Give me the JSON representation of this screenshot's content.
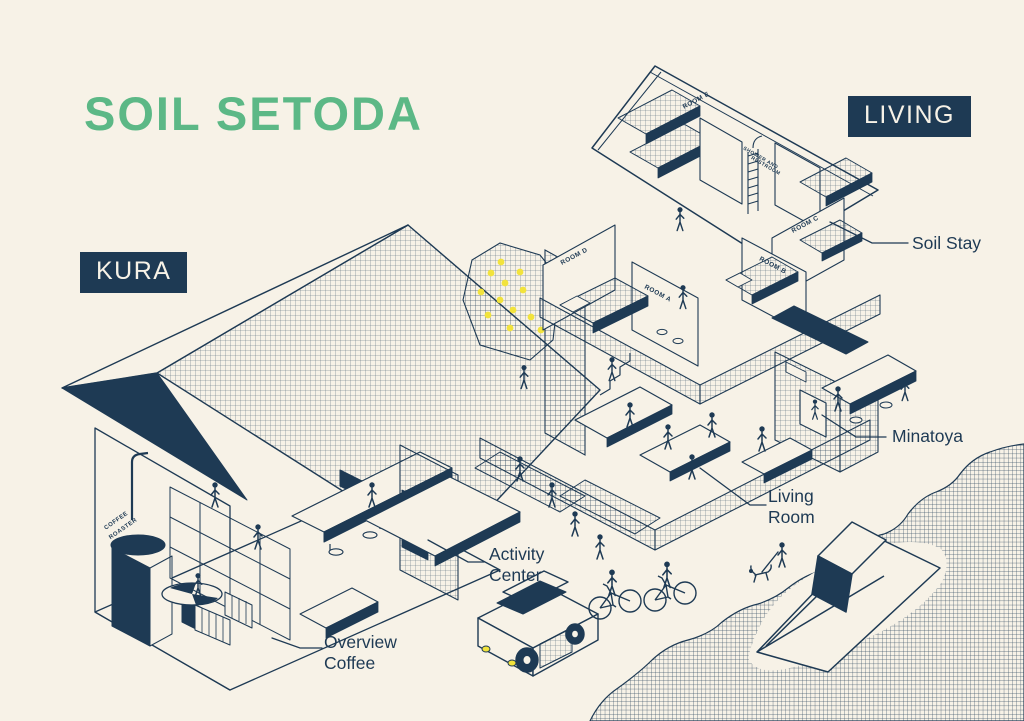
{
  "title": "SOIL SETODA",
  "badges": {
    "kura": "KURA",
    "living": "LIVING"
  },
  "callouts": [
    {
      "id": "soil-stay",
      "label": "Soil Stay"
    },
    {
      "id": "minatoya",
      "label": "Minatoya"
    },
    {
      "id": "living-room",
      "label": "Living Room"
    },
    {
      "id": "activity-center",
      "label": "Activity Center"
    },
    {
      "id": "overview-coffee",
      "label": "Overview Coffee"
    }
  ],
  "room_labels": {
    "room_e": "ROOM E",
    "shower_line1": "SHOWER AND",
    "shower_line2": "RESTROOM",
    "room_d": "ROOM D",
    "room_a": "ROOM A",
    "room_b": "ROOM B",
    "room_c": "ROOM C",
    "coffee_line1": "COFFEE",
    "coffee_line2": "ROASTER"
  },
  "illustration_icons": [
    "kura-building-icon",
    "living-building-icon",
    "climbing-wall-icon",
    "coffee-roaster-icon",
    "bunk-bed-icon",
    "car-icon",
    "bicycle-icon",
    "boat-icon",
    "dog-walker-icon",
    "sea-icon"
  ],
  "colors": {
    "background": "#F7F2E7",
    "ink": "#1E3A54",
    "accent_green": "#5CB886",
    "accent_yellow": "#F2E33C"
  }
}
